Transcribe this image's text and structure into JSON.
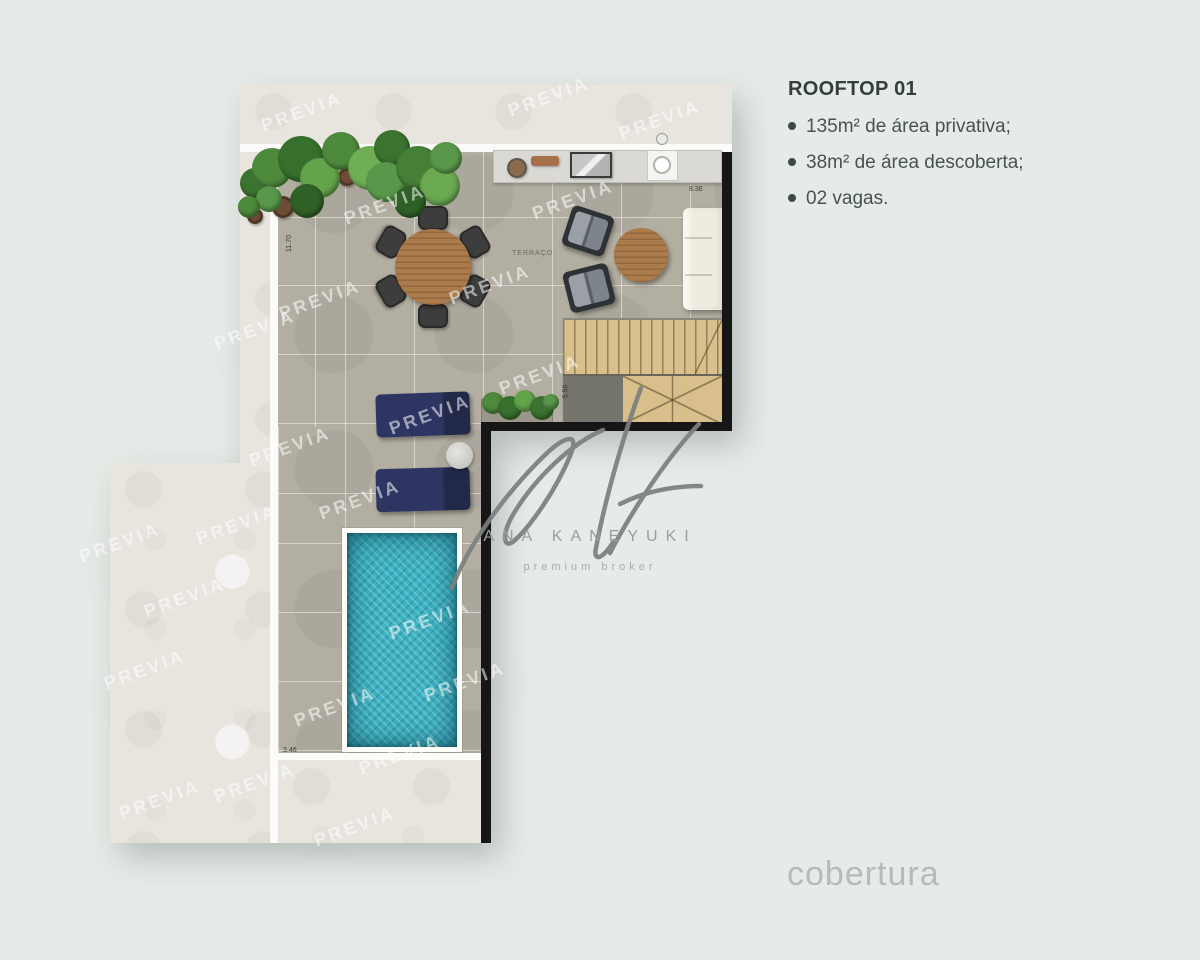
{
  "page": {
    "background_color": "#e7ebe8"
  },
  "info_panel": {
    "title": "ROOFTOP 01",
    "bullets": [
      "135m² de área privativa;",
      "38m² de área descoberta;",
      "02 vagas."
    ]
  },
  "footer": {
    "label": "cobertura"
  },
  "brand": {
    "name": "ANA KANEYUKI",
    "tagline": "premium broker"
  },
  "watermark": {
    "text": "PREVIA",
    "positions": [
      [
        302,
        112
      ],
      [
        549,
        97
      ],
      [
        660,
        120
      ],
      [
        255,
        330
      ],
      [
        385,
        205
      ],
      [
        573,
        200
      ],
      [
        320,
        300
      ],
      [
        490,
        285
      ],
      [
        540,
        375
      ],
      [
        430,
        415
      ],
      [
        290,
        447
      ],
      [
        360,
        500
      ],
      [
        237,
        525
      ],
      [
        120,
        543
      ],
      [
        185,
        598
      ],
      [
        430,
        620
      ],
      [
        145,
        670
      ],
      [
        465,
        682
      ],
      [
        335,
        707
      ],
      [
        400,
        755
      ],
      [
        255,
        783
      ],
      [
        160,
        800
      ],
      [
        355,
        827
      ]
    ]
  },
  "plan": {
    "room_label": "TERRAÇO",
    "dimension_labels": [
      {
        "text": "11.70",
        "x": 281,
        "y": 240,
        "vertical": true
      },
      {
        "text": "8.36",
        "x": 689,
        "y": 186,
        "vertical": false
      },
      {
        "text": "5.58",
        "x": 559,
        "y": 388,
        "vertical": true
      },
      {
        "text": "3.46",
        "x": 283,
        "y": 747,
        "vertical": false
      }
    ]
  },
  "colors": {
    "background": "#e7ebe8",
    "concrete": "#e8e5df",
    "tile": "#b3aea2",
    "wall": "#161616",
    "pool_water": "#3db2c2",
    "lounger_navy": "#2b3158",
    "wood": "#ab7b4b",
    "text_dark": "#3b4845",
    "footer_text": "#b5bbb7",
    "brand_gray": "#99a09c",
    "watermark_white": "rgba(255,255,255,0.55)"
  }
}
